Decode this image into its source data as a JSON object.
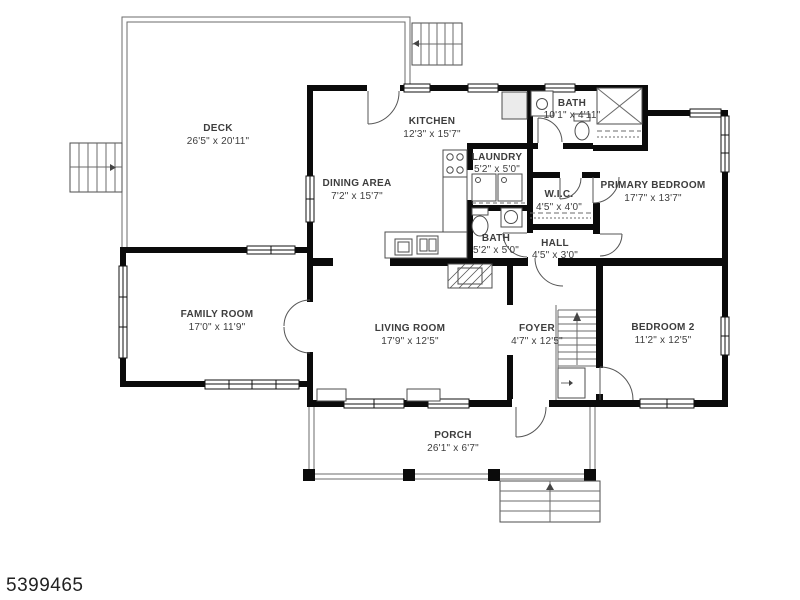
{
  "meta": {
    "listing_id": "5399465"
  },
  "colors": {
    "wall": "#0b0b0b",
    "label": "#3d3d3d",
    "background": "#ffffff"
  },
  "plan": {
    "type": "residential-floor-plan",
    "rooms": [
      {
        "id": "deck",
        "name": "DECK",
        "dims": "26'5\" x 20'11\""
      },
      {
        "id": "kitchen",
        "name": "KITCHEN",
        "dims": "12'3\" x 15'7\""
      },
      {
        "id": "dining",
        "name": "DINING AREA",
        "dims": "7'2\" x 15'7\""
      },
      {
        "id": "bath-upper",
        "name": "BATH",
        "dims": "10'1\" x 4'11\""
      },
      {
        "id": "laundry",
        "name": "LAUNDRY",
        "dims": "5'2\" x 5'0\""
      },
      {
        "id": "wic",
        "name": "W.I.C.",
        "dims": "4'5\" x 4'0\""
      },
      {
        "id": "primary",
        "name": "PRIMARY BEDROOM",
        "dims": "17'7\" x 13'7\""
      },
      {
        "id": "bath-lower",
        "name": "BATH",
        "dims": "5'2\" x 5'0\""
      },
      {
        "id": "hall",
        "name": "HALL",
        "dims": "4'5\" x 3'0\""
      },
      {
        "id": "family",
        "name": "FAMILY ROOM",
        "dims": "17'0\" x 11'9\""
      },
      {
        "id": "living",
        "name": "LIVING ROOM",
        "dims": "17'9\" x 12'5\""
      },
      {
        "id": "foyer",
        "name": "FOYER",
        "dims": "4'7\" x 12'5\""
      },
      {
        "id": "bedroom2",
        "name": "BEDROOM 2",
        "dims": "11'2\" x 12'5\""
      },
      {
        "id": "porch",
        "name": "PORCH",
        "dims": "26'1\" x 6'7\""
      }
    ]
  }
}
